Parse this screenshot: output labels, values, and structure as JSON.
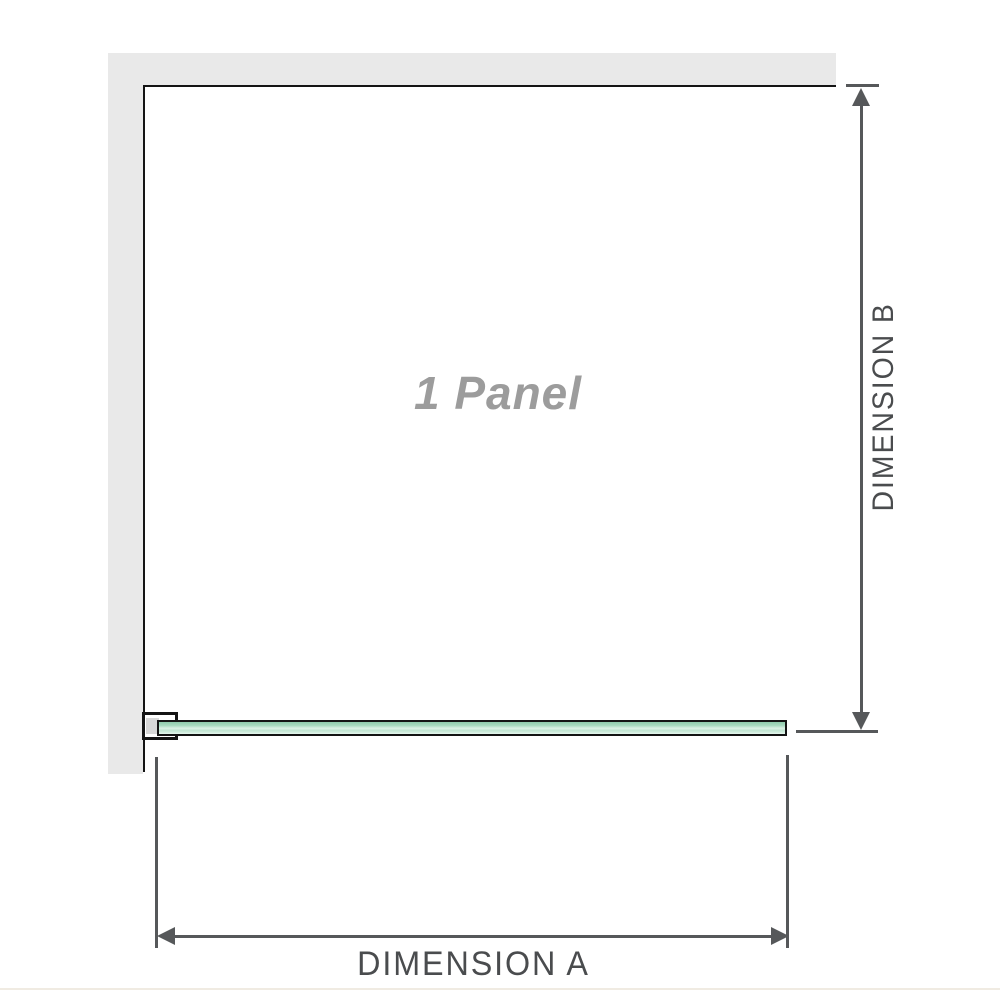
{
  "diagram": {
    "panel_label": "1 Panel",
    "dimension_a_label": "DIMENSION A",
    "dimension_b_label": "DIMENSION B"
  },
  "icons": {
    "arrow_up": "up-arrowhead",
    "arrow_down": "down-arrowhead",
    "arrow_left": "left-arrowhead",
    "arrow_right": "right-arrowhead"
  },
  "colors": {
    "wall_fill": "#e9e9e9",
    "outline": "#141414",
    "dimension_lines": "#56585a",
    "dimension_text": "#4a4c4e",
    "panel_label_text": "#9c9c9c",
    "glass_green_dark": "#8fcbac",
    "glass_green_light": "#e6f6ee",
    "bracket_shim": "#d7d7d7",
    "page_edge_line": "#f0ebe2"
  }
}
